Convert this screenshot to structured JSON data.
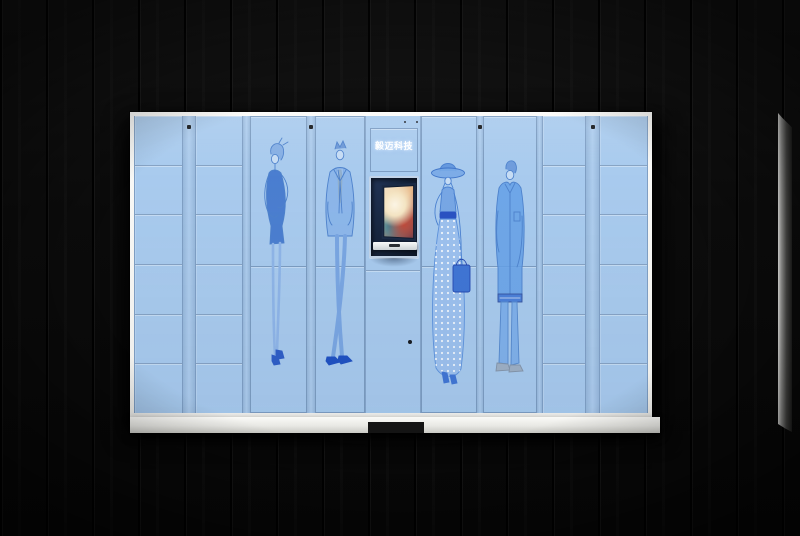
{
  "brand": {
    "label": "毅迈科技"
  },
  "palette": {
    "backdrop": "#0b0b0b",
    "cabinet_face": "#a9cbee",
    "cabinet_frame": "#f3f3f1",
    "panel_seam": "#87a3c4",
    "illustration_blue": "#4e82cc",
    "illustration_dark_blue": "#2d5cc6",
    "screen_bezel": "#16243d",
    "tie_gold": "#c9b06a"
  },
  "cabinet": {
    "console": {
      "brand_label": "毅迈科技",
      "screen_state": "on"
    },
    "columns": [
      {
        "id": "lockers-left-outer",
        "type": "small-lockers",
        "rows": 6
      },
      {
        "id": "lockers-left-inner",
        "type": "small-lockers",
        "rows": 6
      },
      {
        "id": "door-woman-dress",
        "type": "tall-door",
        "artwork": "woman-in-dress"
      },
      {
        "id": "door-man-suit",
        "type": "tall-door",
        "artwork": "man-in-suit"
      },
      {
        "id": "console",
        "type": "control-console"
      },
      {
        "id": "door-woman-hat",
        "type": "tall-door",
        "artwork": "woman-with-hat"
      },
      {
        "id": "door-man-casual",
        "type": "tall-door",
        "artwork": "man-casual"
      },
      {
        "id": "lockers-right-inner",
        "type": "small-lockers",
        "rows": 6
      },
      {
        "id": "lockers-right-outer",
        "type": "small-lockers",
        "rows": 6
      }
    ]
  }
}
